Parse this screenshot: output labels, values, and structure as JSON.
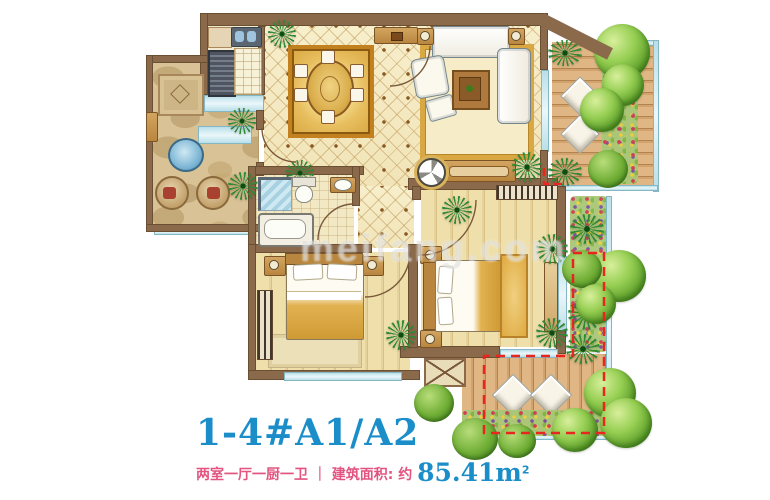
{
  "title": {
    "text": "1-4#A1/A2",
    "color": "#1b8ec9"
  },
  "caption": {
    "layout_text": "两室一厅一厨一卫",
    "separator": "｜",
    "area_label": "建筑面积: 约",
    "area_value": "85.41",
    "area_unit_base": "m",
    "area_unit_sup": "2",
    "text_color": "#e25580",
    "value_color": "#1b8ec9"
  },
  "watermark": {
    "text": "meifang.com"
  },
  "palette": {
    "wall_brown": "#8a6a4b",
    "tile_cream": "#f6ecc6",
    "wood_floor": "#ead9a8",
    "deck_wood": "#d2a36c",
    "stone_terrace": "#d8c296",
    "window_glass": "#bfe2ea",
    "carpet_gold": "#e7bd5d",
    "gift_area_dash_red": "#e8251f",
    "plant_green": "#6fae35"
  }
}
